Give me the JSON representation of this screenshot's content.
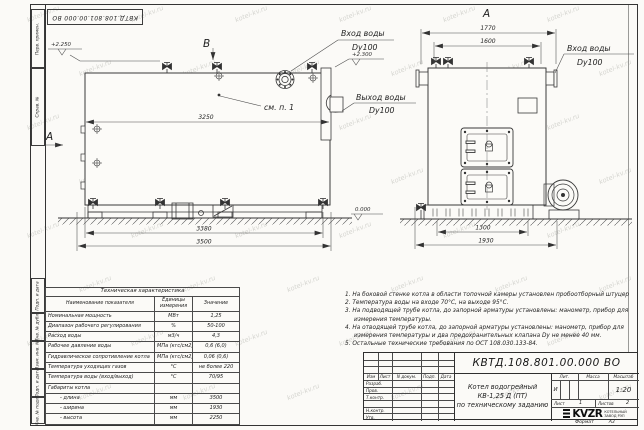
{
  "watermark": {
    "text": "kotel-kv.ru"
  },
  "frame": {
    "strip_labels": [
      "Перв. примен.",
      "Справ. №",
      "Подп. и дата",
      "Инв. № дубл.",
      "Взам. инв. №",
      "Подп. и дата",
      "Инв. № подл."
    ],
    "format_label": "Формат",
    "format_value": "А3"
  },
  "left_view": {
    "view_marker": "B",
    "section_marker": "A",
    "elev_top_left": "+2.250",
    "elev_top_right": "+2.300",
    "elev_ground": "0.000",
    "dim_body_length": "3250",
    "dim_base_length": "3380",
    "dim_total_length": "3500",
    "inlet_label": "Вход воды",
    "inlet_dn": "Dy100",
    "outlet_label": "Выход воды",
    "outlet_dn": "Dy100",
    "see_note": "см. п. 1"
  },
  "front_view": {
    "view_marker": "A",
    "dim_width_outer": "1770",
    "dim_width_inner": "1600",
    "dim_base_inner": "1300",
    "dim_base_outer": "1930",
    "inlet_label": "Вход воды",
    "inlet_dn": "Dy100"
  },
  "spec_table": {
    "title": "Техническая характеристика",
    "col_name": "Наименование показателя",
    "col_units": "Единицы измерения",
    "col_value": "Значение",
    "rows": [
      {
        "name": "Номинальная мощность",
        "units": "МВт",
        "value": "1,25"
      },
      {
        "name": "Диапазон рабочего регулирования",
        "units": "%",
        "value": "50-100"
      },
      {
        "name": "Расход воды",
        "units": "м3/ч",
        "value": "4,3"
      },
      {
        "name": "Рабочее давление воды",
        "units": "МПа (кгс/см2)",
        "value": "0,6 (6,0)"
      },
      {
        "name": "Гидравлическое сопротивление котла",
        "units": "МПа (кгс/см2)",
        "value": "0,06 (0,6)"
      },
      {
        "name": "Температура уходящих газов",
        "units": "°С",
        "value": "не более 220"
      },
      {
        "name": "Температура воды (вход/выход)",
        "units": "°С",
        "value": "70/95"
      },
      {
        "name": "Габариты котла",
        "units": "",
        "value": ""
      },
      {
        "name": "- длина",
        "units": "мм",
        "value": "3500"
      },
      {
        "name": "- ширина",
        "units": "мм",
        "value": "1930"
      },
      {
        "name": "- высота",
        "units": "мм",
        "value": "2250"
      }
    ]
  },
  "notes": {
    "lines": [
      "1. На боковой стенке котла в области топочной камеры установлен пробоотборный штуцер",
      "2. Температура воды на входе 70°С, на выходе 95°С.",
      "3. На подводящей трубе котла, до запорной арматуры установлены: манометр, прибор для",
      "измерения температуры.",
      "4. На отводящей трубе котла, до запорной арматуры установлены: манометр, прибор для",
      "измерения температуры и два предохранительных клапана Dy не менее 40 мм.",
      "5. Остальные технические требования по ОСТ 108.030.133-84."
    ]
  },
  "title_block": {
    "doc_number": "КВТД.108.801.00.000  ВО",
    "product_line1": "Котел водогрейный",
    "product_line2": "КВ-1,25 Д (ПТ)",
    "product_line3": "по техническому заданию",
    "col_izm": "Изм",
    "col_list": "Лист",
    "col_ndoc": "N докум.",
    "col_podp": "Подп.",
    "col_data": "Дата",
    "row_labels": [
      "Разраб.",
      "Пров.",
      "Т.контр.",
      "",
      "Н.контр.",
      "Утв."
    ],
    "lit_label": "Лит.",
    "lit_value": "И",
    "mass_label": "Масса",
    "scale_label": "Масштаб",
    "scale_value": "1:20",
    "sheet_label": "Лист",
    "sheet_value": "1",
    "sheets_label": "Листов",
    "sheets_value": "2",
    "logo_text": "KVZR",
    "logo_sub1": "КОТЕЛЬНЫЙ",
    "logo_sub2": "ЗАВОД РЭП"
  }
}
